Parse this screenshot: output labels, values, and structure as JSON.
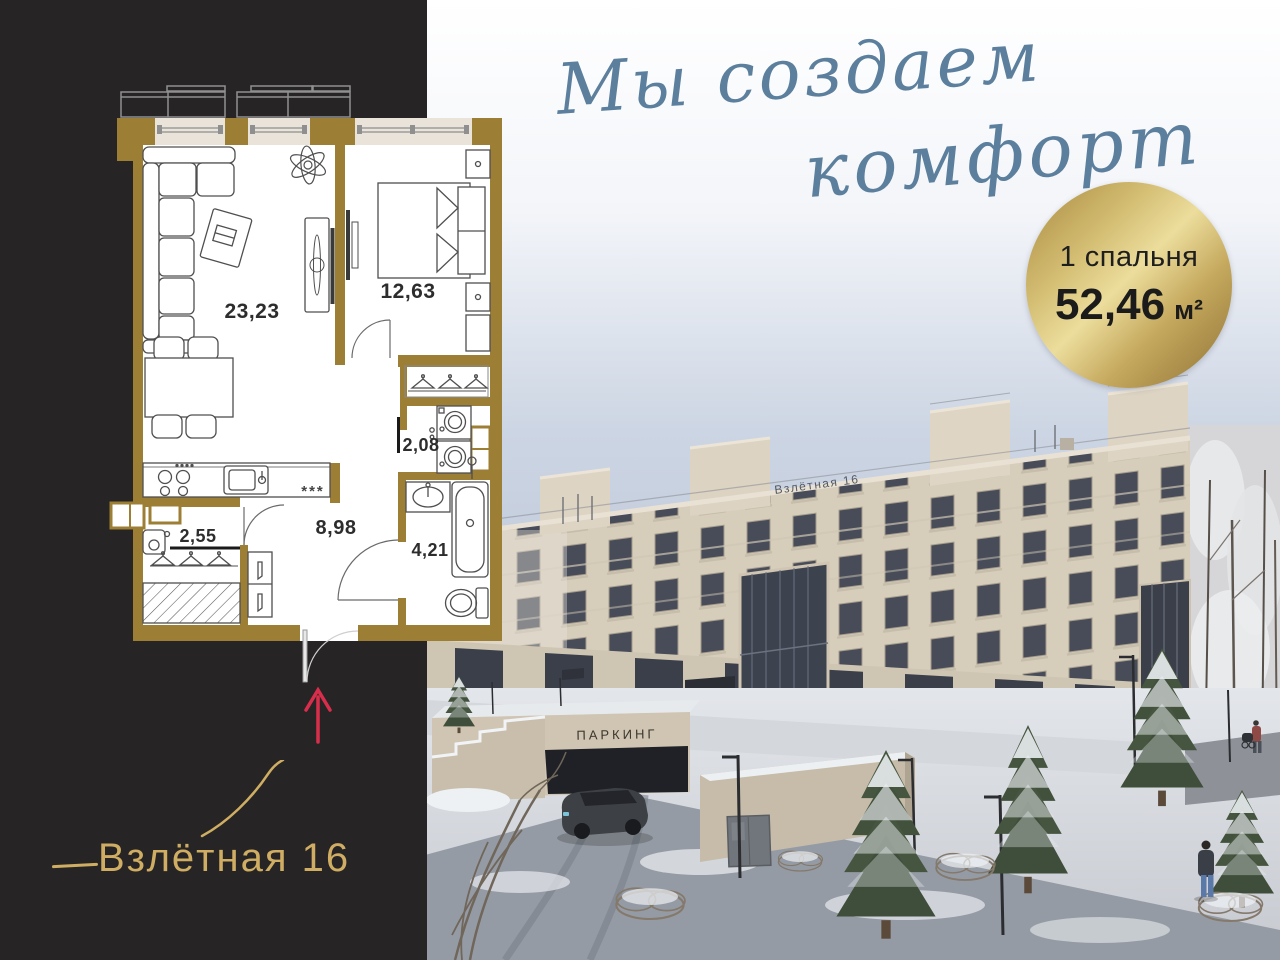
{
  "tagline": {
    "line1": "Мы создаем",
    "line2": "комфорт"
  },
  "badge": {
    "bedrooms_label": "1 спальня",
    "area_value": "52,46",
    "area_unit": "м²"
  },
  "logo": {
    "name": "Взлётная 16"
  },
  "floor_plan": {
    "rooms": [
      {
        "id": "living-kitchen",
        "area": "23,23"
      },
      {
        "id": "bedroom",
        "area": "12,63"
      },
      {
        "id": "laundry",
        "area": "2,08"
      },
      {
        "id": "closet",
        "area": "2,55"
      },
      {
        "id": "hallway",
        "area": "8,98"
      },
      {
        "id": "bathroom",
        "area": "4,21"
      }
    ],
    "fridge_mark": "***"
  },
  "render": {
    "parking_sign": "ПАРКИНГ",
    "roof_sign": "Взлётная 16"
  },
  "colors": {
    "panel_dark": "#272425",
    "wall_gold": "#9c7e35",
    "script_blue": "#5b7f9c",
    "arrow_red": "#d82e4c",
    "badge_gold": "#c9ad62",
    "sky_blue": "#c7d0df",
    "facade_beige": "#d7cdbb"
  }
}
